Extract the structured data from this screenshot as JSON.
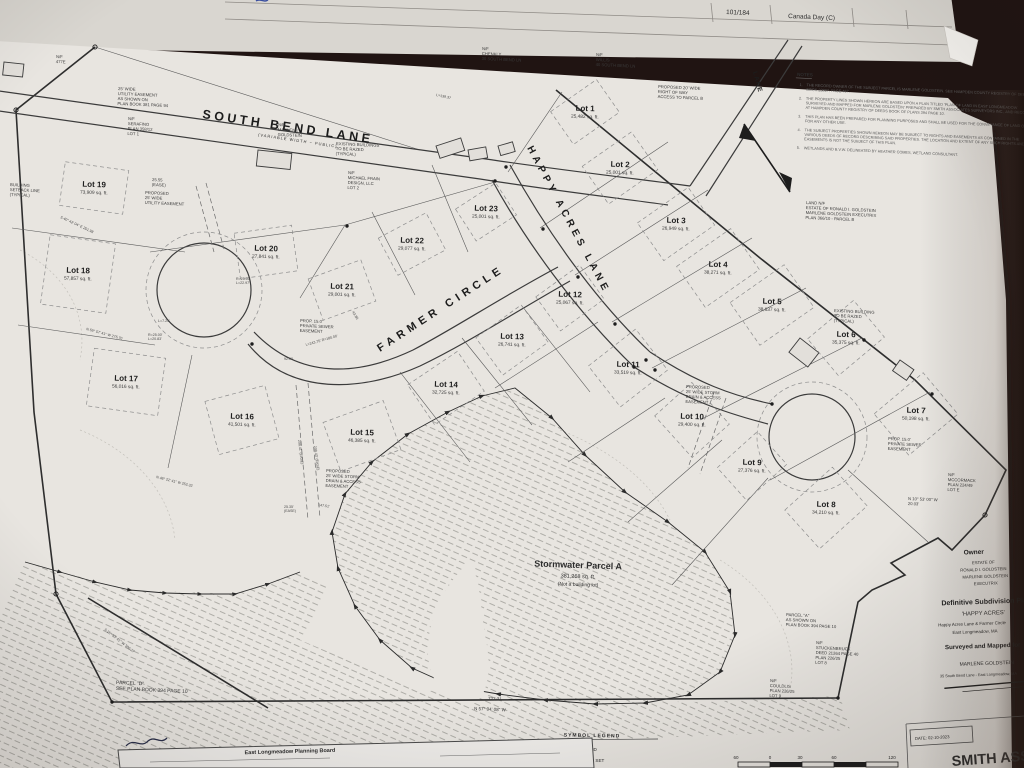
{
  "background_sheet": {
    "page_ref": "101/184",
    "tab_label": "Canada Day (C)"
  },
  "plan": {
    "streets": [
      {
        "name": "SOUTH BEND LANE",
        "sub": "(VARIABLE WIDTH ~ PUBLIC)"
      },
      {
        "name": "HAPPY ACRES LANE"
      },
      {
        "name": "FARMER CIRCLE"
      },
      {
        "name": "LANE"
      }
    ],
    "lots": [
      {
        "name": "Lot 1",
        "area": "25,482 sq. ft.",
        "x": 585,
        "y": 112,
        "w": 56,
        "h": 40,
        "rot": -35
      },
      {
        "name": "Lot 2",
        "area": "25,001 sq. ft.",
        "x": 620,
        "y": 168,
        "w": 60,
        "h": 46,
        "rot": -35
      },
      {
        "name": "Lot 3",
        "area": "26,949 sq. ft.",
        "x": 676,
        "y": 224,
        "w": 62,
        "h": 46,
        "rot": -35
      },
      {
        "name": "Lot 4",
        "area": "38,271 sq. ft.",
        "x": 718,
        "y": 268,
        "w": 66,
        "h": 50,
        "rot": -35
      },
      {
        "name": "Lot 5",
        "area": "38,637 sq. ft.",
        "x": 772,
        "y": 305,
        "w": 66,
        "h": 52,
        "rot": -35
      },
      {
        "name": "Lot 6",
        "area": "35,375 sq. ft.",
        "x": 846,
        "y": 338,
        "w": 60,
        "h": 48,
        "rot": -40
      },
      {
        "name": "Lot 7",
        "area": "50,198 sq. ft.",
        "x": 916,
        "y": 414,
        "w": 64,
        "h": 54,
        "rot": -40
      },
      {
        "name": "Lot 8",
        "area": "34,210 sq. ft.",
        "x": 826,
        "y": 508,
        "w": 64,
        "h": 52,
        "rot": -42
      },
      {
        "name": "Lot 9",
        "area": "27,376 sq. ft.",
        "x": 752,
        "y": 466,
        "w": 54,
        "h": 44,
        "rot": -42
      },
      {
        "name": "Lot 10",
        "area": "29,400 sq. ft.",
        "x": 692,
        "y": 420,
        "w": 50,
        "h": 56,
        "rot": -42
      },
      {
        "name": "Lot 11",
        "area": "33,519 sq. ft.",
        "x": 628,
        "y": 368,
        "w": 60,
        "h": 52,
        "rot": -38
      },
      {
        "name": "Lot 12",
        "area": "25,067 sq. ft.",
        "x": 570,
        "y": 298,
        "w": 54,
        "h": 42,
        "rot": -36
      },
      {
        "name": "Lot 13",
        "area": "26,741 sq. ft.",
        "x": 512,
        "y": 340,
        "w": 56,
        "h": 46,
        "rot": -36
      },
      {
        "name": "Lot 14",
        "area": "32,725 sq. ft.",
        "x": 446,
        "y": 388,
        "w": 60,
        "h": 48,
        "rot": -34
      },
      {
        "name": "Lot 15",
        "area": "46,385 sq. ft.",
        "x": 362,
        "y": 436,
        "w": 64,
        "h": 52,
        "rot": -20
      },
      {
        "name": "Lot 16",
        "area": "41,501 sq. ft.",
        "x": 242,
        "y": 420,
        "w": 62,
        "h": 55,
        "rot": -15
      },
      {
        "name": "Lot 17",
        "area": "56,016 sq. ft.",
        "x": 126,
        "y": 382,
        "w": 72,
        "h": 58,
        "rot": 8
      },
      {
        "name": "Lot 18",
        "area": "57,857 sq. ft.",
        "x": 78,
        "y": 274,
        "w": 66,
        "h": 70,
        "rot": 8
      },
      {
        "name": "Lot 19",
        "area": "73,909 sq. ft.",
        "x": 94,
        "y": 188,
        "w": 64,
        "h": 44,
        "rot": 8
      },
      {
        "name": "Lot 20",
        "area": "27,841 sq. ft.",
        "x": 266,
        "y": 252,
        "w": 58,
        "h": 46,
        "rot": -8
      },
      {
        "name": "Lot 21",
        "area": "29,001 sq. ft.",
        "x": 342,
        "y": 290,
        "w": 56,
        "h": 44,
        "rot": -20
      },
      {
        "name": "Lot 22",
        "area": "29,077 sq. ft.",
        "x": 412,
        "y": 244,
        "w": 54,
        "h": 42,
        "rot": -28
      },
      {
        "name": "Lot 23",
        "area": "25,001 sq. ft.",
        "x": 486,
        "y": 212,
        "w": 48,
        "h": 38,
        "rot": -33
      }
    ],
    "parcel_a": {
      "name": "Stormwater Parcel A",
      "area": "381,268 sq. ft.",
      "note": "(Not a building lot)"
    },
    "annotations": [
      {
        "x": 10,
        "y": 186,
        "text": "BUILDING\nSETBACK LINE\n(TYPICAL)"
      },
      {
        "x": 152,
        "y": 181,
        "text": "25.55\n(EASE)"
      },
      {
        "x": 145,
        "y": 194,
        "text": "PROPOSED\n25' WIDE\nUTILITY EASEMENT"
      },
      {
        "x": 118,
        "y": 90,
        "text": "25' WIDE\nUTILITY EASEMENT\nAS SHOWN ON\nPLAN BOOK 381 PAGE 94"
      },
      {
        "x": 128,
        "y": 120,
        "text": "N/F\nSERAFINO\nPLAN 358/12\nLOT 1"
      },
      {
        "x": 278,
        "y": 126,
        "text": "N/F\nMARLENE\nGOLDSTEIN"
      },
      {
        "x": 336,
        "y": 145,
        "text": "EXISTING BUILDINGS\nTO BE RAZED\n(TYPICAL)"
      },
      {
        "x": 348,
        "y": 174,
        "text": "N/F\nMICHAEL FRAIN\nDESIGN, LLC\nLOT 2"
      },
      {
        "x": 482,
        "y": 50,
        "text": "N/F\nCHENKLY\n30 SOUTH BEND LN"
      },
      {
        "x": 596,
        "y": 56,
        "text": "N/F\nWILLIS\n40 SOUTH BEND LN"
      },
      {
        "x": 56,
        "y": 58,
        "text": "N/F\n477E"
      },
      {
        "x": 658,
        "y": 88,
        "text": "PROPOSED 20' WIDE\nRIGHT OF WAY\nACCESS TO PARCEL B"
      },
      {
        "x": 806,
        "y": 204,
        "text": "LAND N/F\nESTATE OF RONALD I. GOLDSTEIN\nMARLENE GOLDSTEIN EXECUTRIX\nPLAN 366/10 - PARCEL B"
      },
      {
        "x": 834,
        "y": 312,
        "text": "EXISTING BUILDING\nTO BE RAZED\n(TYPICAL)"
      },
      {
        "x": 300,
        "y": 322,
        "text": "PROP. 15.0'\nPRIVATE SEWER\nEASEMENT"
      },
      {
        "x": 888,
        "y": 440,
        "text": "PROP. 15.0'\nPRIVATE SEWER\nEASEMENT"
      },
      {
        "x": 686,
        "y": 388,
        "text": "PROPOSED\n25' WIDE STORM\nDRAIN & ACCESS\nEASEMENT"
      },
      {
        "x": 326,
        "y": 472,
        "text": "PROPOSED\n25' WIDE STORM\nDRAIN & ACCESS\nEASEMENT"
      },
      {
        "x": 948,
        "y": 476,
        "text": "N/F\nMCCORMACK\nPLAN 224/49\nLOT E"
      },
      {
        "x": 908,
        "y": 500,
        "text": "N 10° 53' 00\" W\n20.03'"
      },
      {
        "x": 786,
        "y": 616,
        "text": "PARCEL \"A\"\nAS SHOWN ON\nPLAN BOOK 394 PAGE 10"
      },
      {
        "x": 816,
        "y": 644,
        "text": "N/F\nSTUCKENBRUCK\nDEED 21264 PAGE 40\nPLAN 226/25\nLOT 8"
      },
      {
        "x": 770,
        "y": 682,
        "text": "N/F\nCOULDLIS\nPLAN 226/25\nLOT 9"
      },
      {
        "x": 116,
        "y": 684,
        "size": 5,
        "text": "PARCEL \"D\"\nSEE PLAN BOOK 394 PAGE 10"
      },
      {
        "x": 488,
        "y": 700,
        "size": 4.5,
        "text": "723.31"
      },
      {
        "x": 474,
        "y": 710,
        "size": 4.5,
        "text": "N 57° 34' 08\" W"
      }
    ],
    "dimensions": [
      {
        "x": 60,
        "y": 218,
        "rot": 25,
        "text": "S 40° 42' 04\" E  251.98"
      },
      {
        "x": 86,
        "y": 330,
        "rot": 15,
        "text": "N 59° 57' 41\" W  275.70"
      },
      {
        "x": 158,
        "y": 322,
        "rot": 0,
        "text": "L=7.25'"
      },
      {
        "x": 148,
        "y": 336,
        "rot": 0,
        "text": "R=25.00'\nL=20.83'"
      },
      {
        "x": 236,
        "y": 280,
        "rot": 0,
        "text": "R=25.00'\nL=22.97'"
      },
      {
        "x": 306,
        "y": 346,
        "rot": -16,
        "text": "L=243.75'  R=180.00'"
      },
      {
        "x": 352,
        "y": 312,
        "rot": 60,
        "text": "43.86"
      },
      {
        "x": 284,
        "y": 360,
        "rot": 0,
        "text": "92.00"
      },
      {
        "x": 436,
        "y": 96,
        "rot": 12,
        "text": "L=139.37"
      },
      {
        "x": 156,
        "y": 478,
        "rot": 14,
        "text": "N 48° 22' 41\" W  252.32"
      },
      {
        "x": 318,
        "y": 506,
        "rot": 8,
        "text": "147.51'"
      },
      {
        "x": 104,
        "y": 630,
        "rot": 38,
        "text": "S 25° 53' 41\" W  300.27"
      },
      {
        "x": 298,
        "y": 440,
        "rot": 83,
        "text": "208.41'  (EASE)"
      },
      {
        "x": 314,
        "y": 446,
        "rot": 83,
        "text": "208.43'  (EASE)"
      },
      {
        "x": 284,
        "y": 508,
        "rot": 0,
        "text": "25.35'\n(EASE)"
      }
    ],
    "buildings": [
      {
        "x": 258,
        "y": 150,
        "w": 34,
        "h": 16,
        "rot": 6
      },
      {
        "x": 436,
        "y": 146,
        "w": 26,
        "h": 13,
        "rot": -18
      },
      {
        "x": 468,
        "y": 150,
        "w": 18,
        "h": 11,
        "rot": -10
      },
      {
        "x": 498,
        "y": 146,
        "w": 15,
        "h": 10,
        "rot": -16
      },
      {
        "x": 800,
        "y": 338,
        "w": 24,
        "h": 18,
        "rot": 38
      },
      {
        "x": 900,
        "y": 360,
        "w": 17,
        "h": 13,
        "rot": 35
      },
      {
        "x": 4,
        "y": 62,
        "w": 20,
        "h": 13,
        "rot": 6
      }
    ],
    "notes": {
      "heading": "NOTES",
      "items": [
        "THE RECORD OWNER OF THE SUBJECT PARCEL IS MARLENE GOLDSTEIN. SEE HAMPDEN COUNTY REGISTRY OF DEEDS BOOK 23807, PAGE 467.",
        "THE PROPERTY LINES SHOWN HEREON ARE BASED UPON A PLAN TITLED 'PLAN OF LAND IN EAST LONGMEADOW SURVEYED AND MAPPED FOR MARLENE GOLDSTEIN' PREPARED BY SMITH ASSOCIATES SURVEYORS INC., AND RECORDED AT HAMPDEN COUNTY REGISTRY OF DEEDS BOOK OF PLANS 394 PAGE 10.",
        "THIS PLAN HAS BEEN PREPARED FOR PLANNING PURPOSES AND SHALL BE USED FOR THE CONVEYANCE OF LAND OR FOR ANY OTHER USE.",
        "THE SUBJECT PROPERTIES SHOWN HEREON MAY BE SUBJECT TO RIGHTS AND EASEMENTS AS CONTAINED IN THE VARIOUS DEEDS OF RECORD DESCRIBING SAID PROPERTIES. THE LOCATION AND EXTENT OF ANY SUCH RIGHTS AND EASEMENTS IS NOT THE SUBJECT OF THIS PLAN.",
        "WETLANDS AND B.V.W. DELINEATED BY HEATHER COMES, WETLAND CONSULTANT."
      ]
    },
    "legend": {
      "title": "SYMBOL LEGEND",
      "items": [
        {
          "symbol": "open-circle",
          "label": "IRON PIPE FOUND"
        },
        {
          "symbol": "filled-circle",
          "label": "IRON PIPE TO BE SET"
        }
      ]
    },
    "scale_bar": {
      "labels": [
        "60",
        "0",
        "30",
        "60",
        "120"
      ]
    },
    "title_block": {
      "owner_heading": "Owner",
      "owner_line1": "ESTATE OF",
      "owner_line2": "RONALD I. GOLDSTEIN",
      "owner_line3": "MARLENE GOLDSTEIN",
      "owner_line4": "EXECUTRIX",
      "plan_type": "Definitive Subdivision Plan",
      "subdivision_name": "'HAPPY ACRES'",
      "streets_line": "Happy Acres Lane & Farmer Circle",
      "town_line": "East Longmeadow, MA",
      "surveyed_heading": "Surveyed and Mapped for",
      "client_name": "MARLENE GOLDSTEIN",
      "client_address": "35 South Bend Lane - East Longmeadow, MA",
      "date_label": "DATE: 02-10-2023",
      "firm_name": "SMITH ASS"
    },
    "approval_box": {
      "title": "East Longmeadow Planning Board"
    }
  }
}
